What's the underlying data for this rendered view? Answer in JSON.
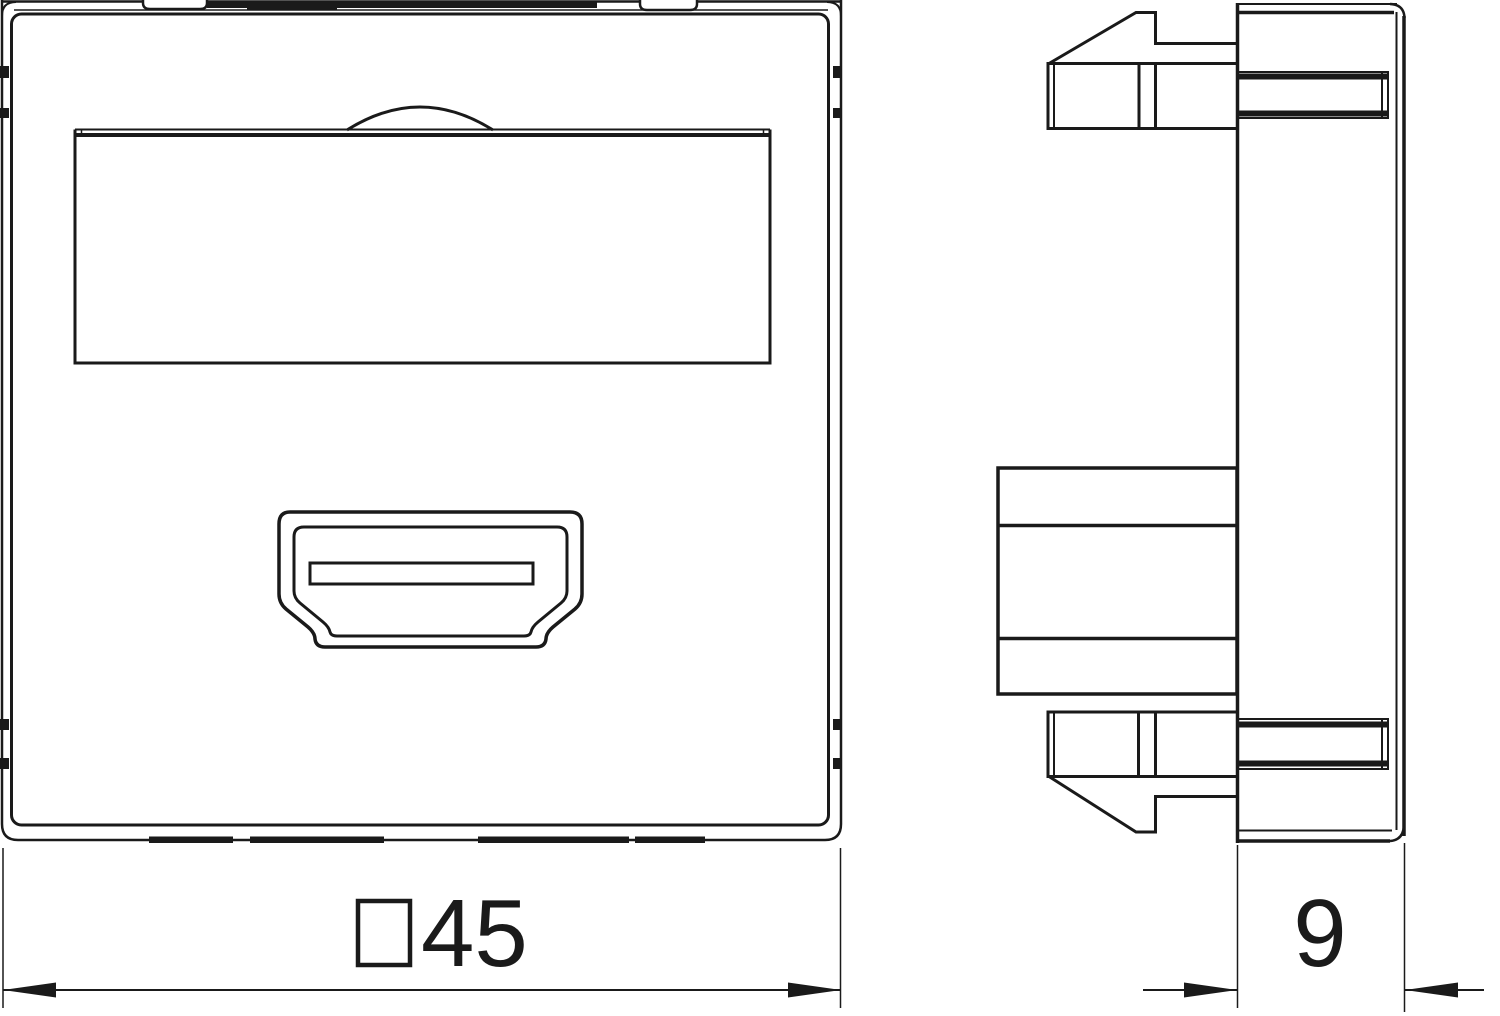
{
  "drawing": {
    "kind": "technical-line-drawing",
    "colors": {
      "line": "#1a1a1a",
      "background": "#ffffff"
    }
  },
  "dimensions": {
    "front_width": {
      "symbol": "□",
      "value": "45"
    },
    "side_depth": {
      "value": "9"
    }
  }
}
